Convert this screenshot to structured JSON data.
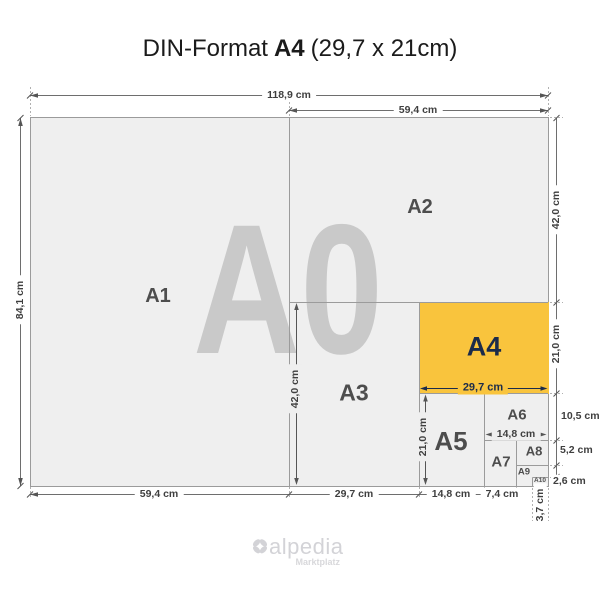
{
  "title": {
    "prefix": "DIN-Format",
    "format": "A4",
    "size": "(29,7 x 21cm)"
  },
  "watermark": "A0",
  "paper_labels": {
    "a1": "A1",
    "a2": "A2",
    "a3": "A3",
    "a4": "A4",
    "a5": "A5",
    "a6": "A6",
    "a7": "A7",
    "a8": "A8",
    "a9": "A9",
    "a10": "A10"
  },
  "dimensions": {
    "a0_width": "118,9 cm",
    "a2_width": "59,4 cm",
    "a0_height": "84,1 cm",
    "a2_height": "42,0 cm",
    "a4_height": "21,0 cm",
    "a6_height": "10,5 cm",
    "a8_height": "5,2 cm",
    "a10_height": "2,6 cm",
    "a1_width": "59,4 cm",
    "a3_width": "29,7 cm",
    "a5_width": "14,8 cm",
    "a7_width": "7,4 cm",
    "a9_width": "3,7 cm",
    "a3_height": "42,0 cm",
    "a5_height": "21,0 cm",
    "a4_width": "29,7 cm",
    "a6_width": "14,8 cm"
  },
  "colors": {
    "a4_fill": "#F9C43D",
    "a4_text": "#1B2B4A",
    "paper_fill": "#EFEFEF",
    "paper_border": "#9B9B9B",
    "watermark": "#C9C9C9",
    "dimension_text": "#3F3F3F",
    "label_text": "#4D4D4D",
    "logo": "#D3D3D7"
  },
  "logo": {
    "name": "alpedia",
    "tagline": "Marktplatz"
  }
}
